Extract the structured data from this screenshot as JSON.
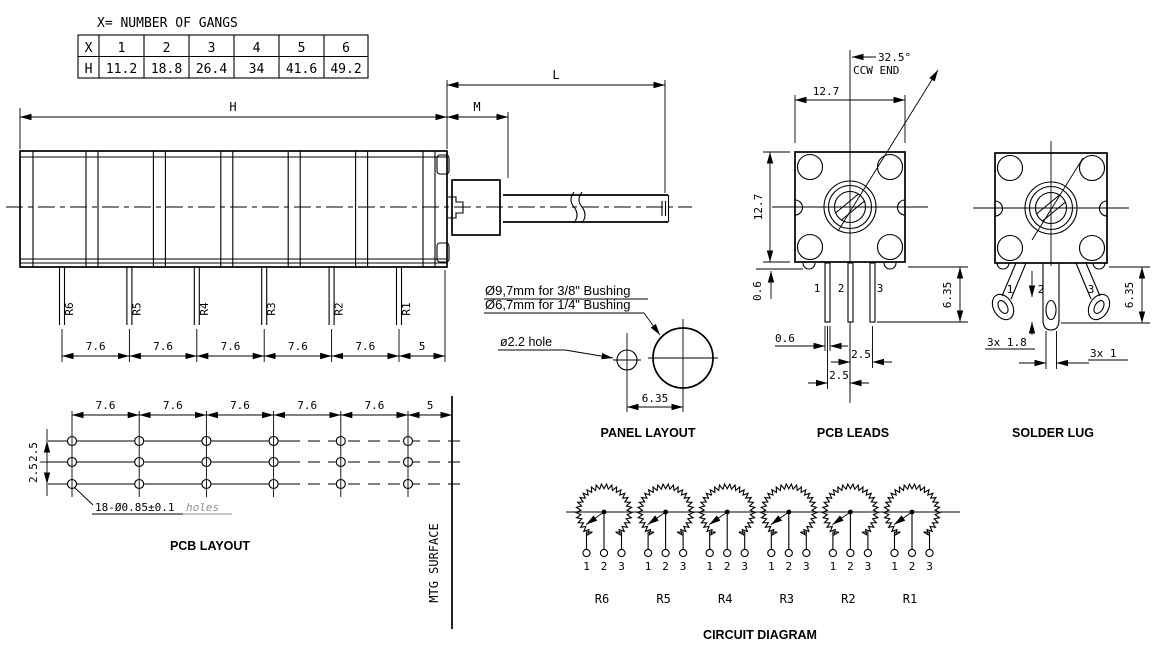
{
  "gang_table": {
    "title": "X= NUMBER OF GANGS",
    "row_x": [
      "X",
      "1",
      "2",
      "3",
      "4",
      "5",
      "6"
    ],
    "row_h": [
      "H",
      "11.2",
      "18.8",
      "26.4",
      "34",
      "41.6",
      "49.2"
    ]
  },
  "side_view": {
    "dim_h_label": "H",
    "dim_m_label": "M",
    "dim_l_label": "L",
    "pin_labels": [
      "R6",
      "R5",
      "R4",
      "R3",
      "R2",
      "R1"
    ],
    "pin_spacings": [
      "7.6",
      "7.6",
      "7.6",
      "7.6",
      "7.6",
      "5"
    ]
  },
  "pcb_layout": {
    "title": "PCB LAYOUT",
    "col_spacings": [
      "7.6",
      "7.6",
      "7.6",
      "7.6",
      "7.6",
      "5"
    ],
    "row_spacings": [
      "2.5",
      "2.5"
    ],
    "holes_note": "18-Ø0.85±0.1",
    "holes_note_suffix": "holes",
    "mtg_surface_label": "MTG SURFACE"
  },
  "panel_layout": {
    "title": "PANEL LAYOUT",
    "bushing_note_1": "Ø9,7mm for 3/8\" Bushing",
    "bushing_note_2": "Ø6,7mm for 1/4\" Bushing",
    "hole_note": "ø2.2  hole",
    "center_distance": "6.35"
  },
  "pcb_leads": {
    "title": "PCB LEADS",
    "angle_label": "32.5°",
    "angle_ref": "CCW END",
    "width": "12.7",
    "height": "12.7",
    "standoff": "0.6",
    "lead_width": "0.6",
    "lead_length": "6.35",
    "pitch_23": "2.5",
    "pitch_12": "2.5",
    "pin_numbers": [
      "1",
      "2",
      "3"
    ]
  },
  "solder_lug": {
    "title": "SOLDER LUG",
    "hole_dim": "3x 1.8",
    "lug_thickness": "3x 1",
    "lug_length": "6.35",
    "pin_numbers": [
      "1",
      "2",
      "3"
    ]
  },
  "circuit_diagram": {
    "title": "CIRCUIT DIAGRAM",
    "pot_labels": [
      "R6",
      "R5",
      "R4",
      "R3",
      "R2",
      "R1"
    ],
    "terminal_numbers": [
      "1",
      "2",
      "3"
    ]
  },
  "colors": {
    "line": "#000000",
    "muted": "#8f8f8f",
    "background": "#ffffff"
  }
}
